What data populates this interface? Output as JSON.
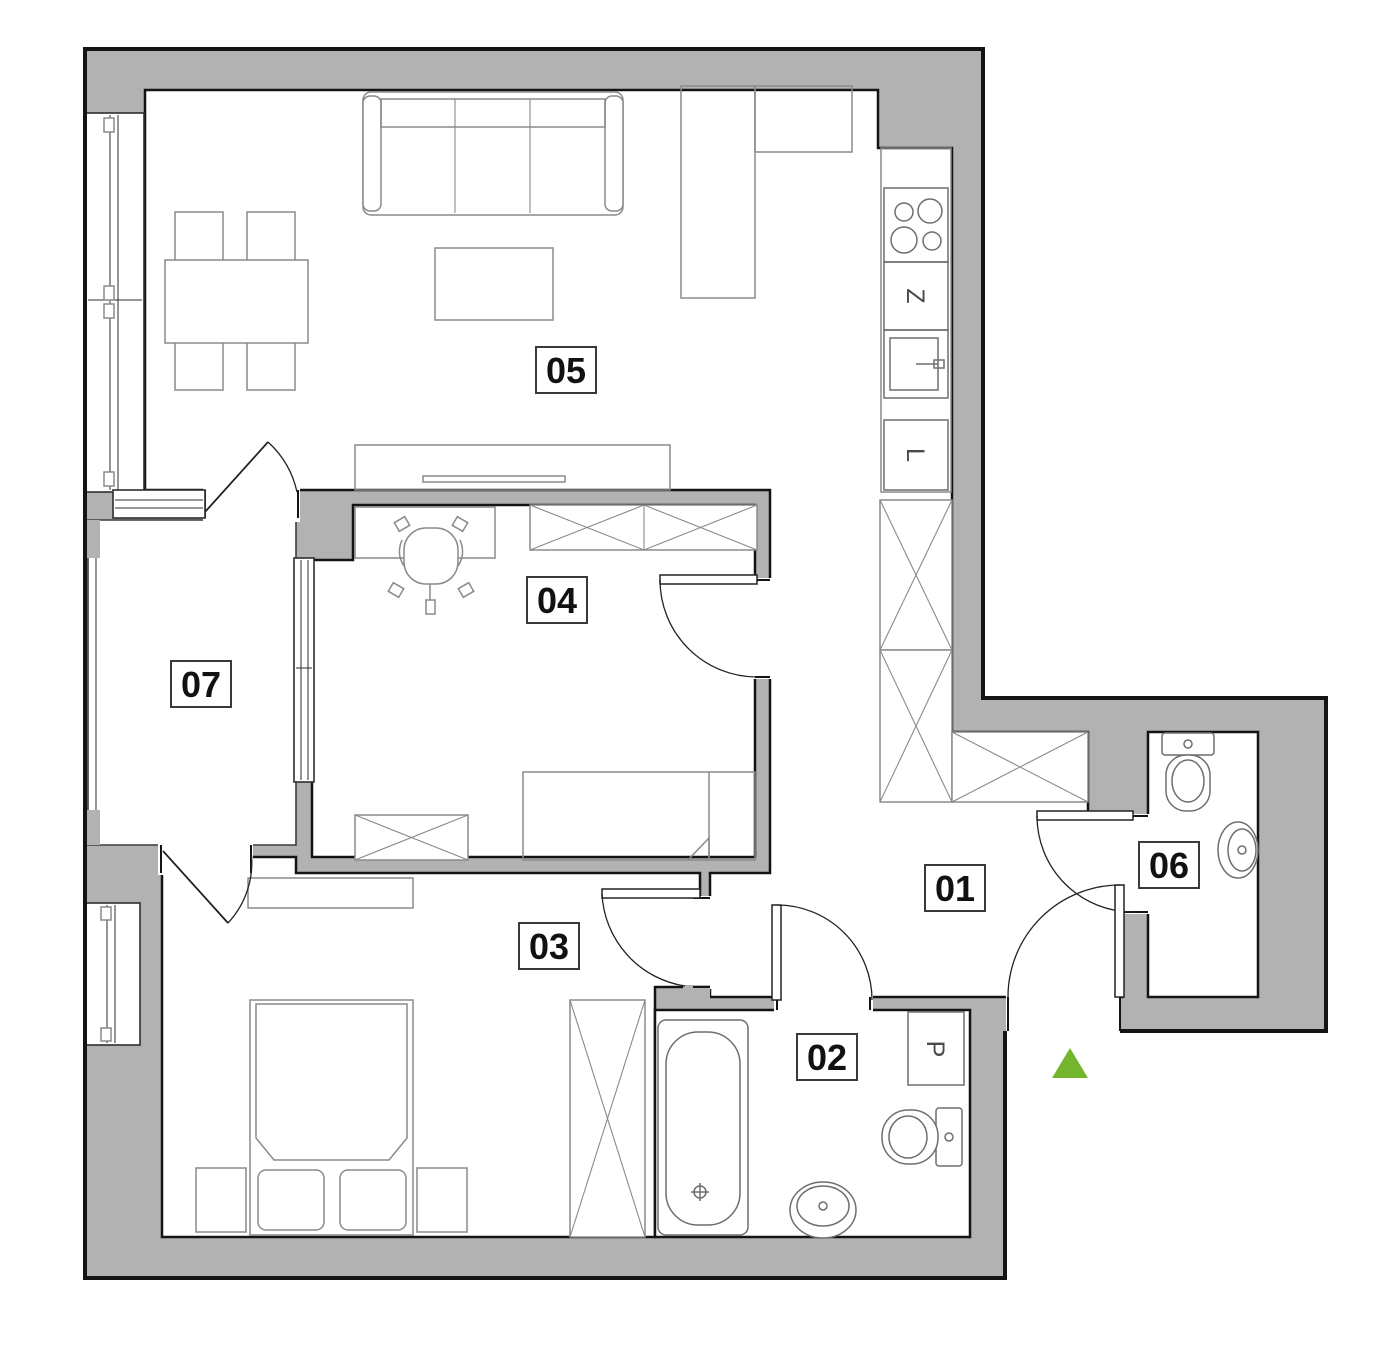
{
  "floor_plan": {
    "title": "apartment-floor-plan",
    "room_labels": [
      {
        "number": "01"
      },
      {
        "number": "02"
      },
      {
        "number": "03"
      },
      {
        "number": "04"
      },
      {
        "number": "05"
      },
      {
        "number": "06"
      },
      {
        "number": "07"
      }
    ],
    "appliance_labels": {
      "dishwasher": "Z",
      "fridge": "L",
      "washing_machine": "P"
    },
    "colors": {
      "wall_fill": "#b2b2b2",
      "line": "#141414",
      "furniture_line": "#8a8a8a",
      "entrance_marker_green": "#74b52e"
    }
  }
}
